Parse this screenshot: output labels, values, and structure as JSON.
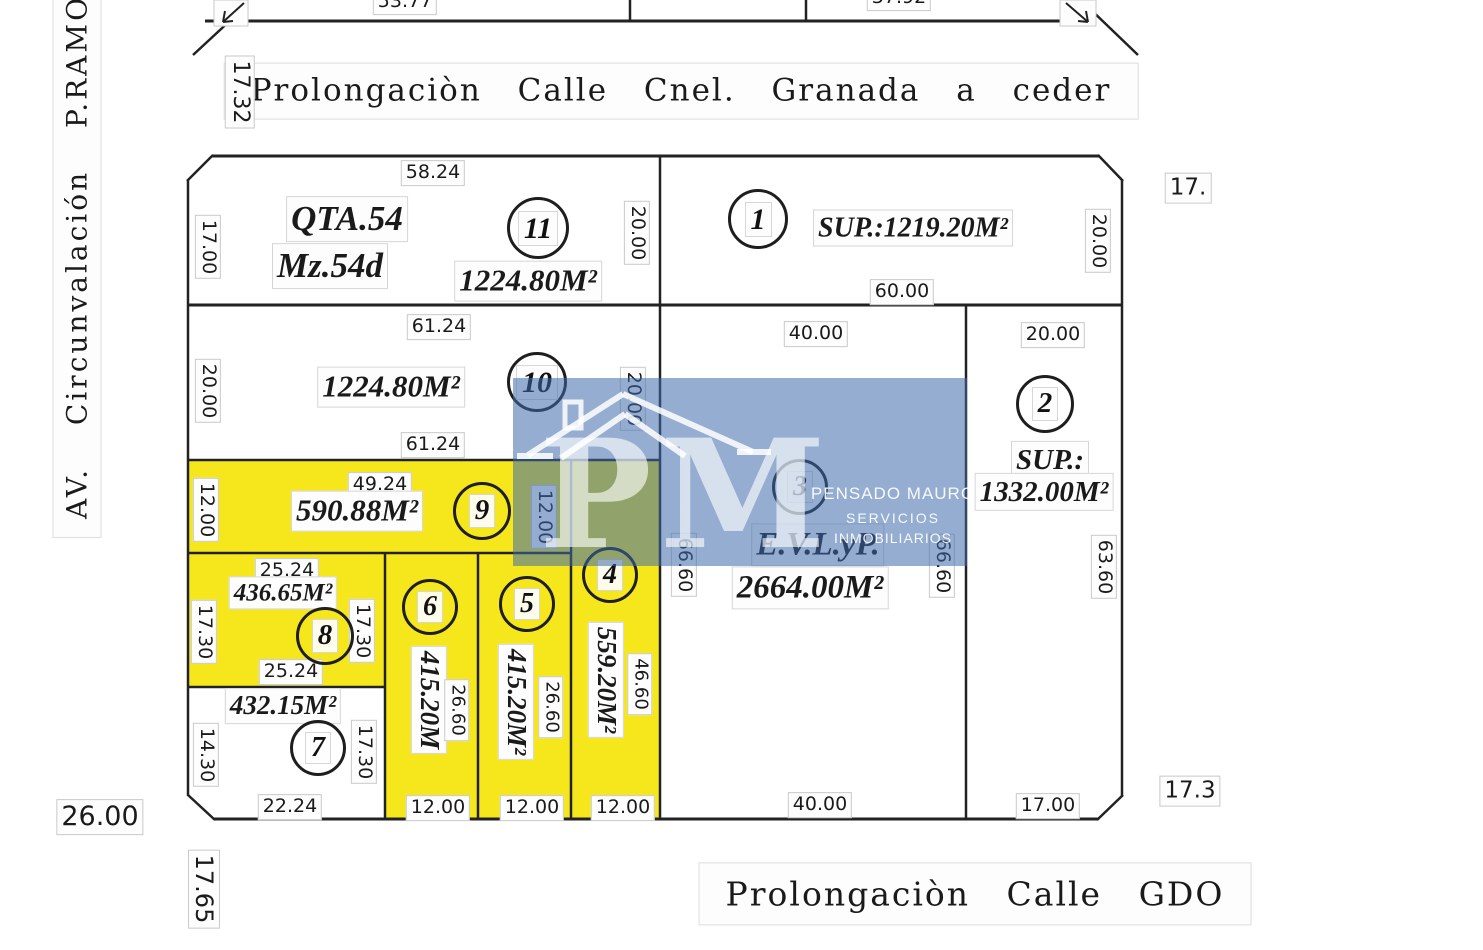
{
  "streets": {
    "top": "Prolongaciòn Calle Cnel. Granada a ceder",
    "bottom": "Prolongaciòn Calle GDO",
    "left": "AV. Circunvalación P.RAMO"
  },
  "outside_dims": {
    "top_strip_left": "53.77",
    "top_strip_right": "37.92",
    "top_left_vertical": "17.32",
    "right_top": "17.",
    "right_bottom": "17.3",
    "bottom_left": "26.00",
    "bottom_left_vertical": "17.65"
  },
  "watermark": {
    "initials": "PM",
    "company_line1": "PENSADO MAURO",
    "company_line2": "SERVICIOS",
    "company_line3": "INMOBILIARIOS"
  },
  "colors": {
    "lot_highlight": "#f6e71d",
    "watermark_blue": "rgba(62,105,170,0.55)",
    "line": "#222222"
  },
  "lots": {
    "lot11": {
      "number": "11",
      "block_name": "QTA.54",
      "block_mz": "Mz.54d",
      "area": "1224.80M²",
      "dim_top": "58.24",
      "dim_left": "17.00",
      "dim_right": "20.00"
    },
    "lot1": {
      "number": "1",
      "area": "SUP.:1219.20M²",
      "dim_bottom": "60.00",
      "dim_right": "20.00"
    },
    "lot10": {
      "number": "10",
      "area": "1224.80M²",
      "dim_top": "61.24",
      "dim_bottom": "61.24",
      "dim_left": "20.00",
      "dim_right": "20.00"
    },
    "lot2": {
      "number": "2",
      "sup_label": "SUP.:",
      "area": "1332.00M²",
      "dim_top": "20.00",
      "dim_right": "63.60",
      "dim_bottom": "17.00"
    },
    "lot3": {
      "number": "3",
      "use_label": "E.V.L.yP.",
      "area": "2664.00M²",
      "dim_top": "40.00",
      "dim_left": "66.60",
      "dim_right": "66.60",
      "dim_bottom": "40.00"
    },
    "lot9": {
      "number": "9",
      "area": "590.88M²",
      "dim_top": "49.24",
      "dim_left": "12.00",
      "dim_right": "12.00"
    },
    "lot8": {
      "number": "8",
      "area": "436.65M²",
      "dim_top": "25.24",
      "dim_bottom": "25.24",
      "dim_left": "17.30",
      "dim_right": "17.30"
    },
    "lot7": {
      "number": "7",
      "area": "432.15M²",
      "dim_left": "14.30",
      "dim_right": "17.30",
      "dim_bottom": "22.24"
    },
    "lot6": {
      "number": "6",
      "area": "415.20M",
      "dim_side": "26.60",
      "dim_bottom": "12.00"
    },
    "lot5": {
      "number": "5",
      "area": "415.20M²",
      "dim_side": "26.60",
      "dim_bottom": "12.00"
    },
    "lot4": {
      "number": "4",
      "area": "559.20M²",
      "dim_side": "46.60",
      "dim_bottom": "12.00"
    }
  }
}
